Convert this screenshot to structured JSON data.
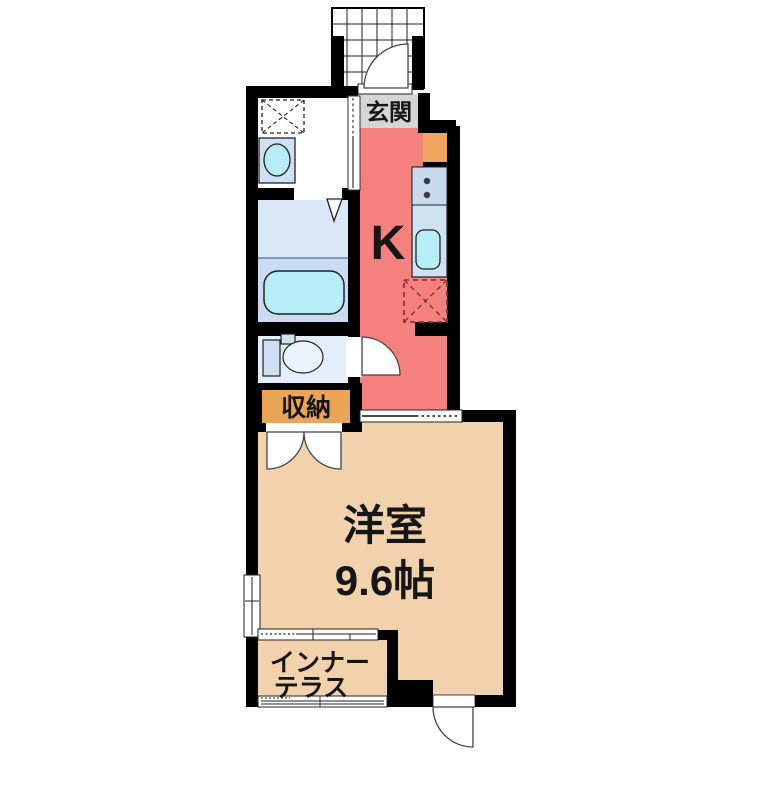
{
  "plan": {
    "title": "1K apartment floor plan",
    "labels": {
      "entrance": "玄関",
      "kitchen": "K",
      "storage": "収納",
      "room_name": "洋室",
      "room_size": "9.6帖",
      "terrace_line1": "インナー",
      "terrace_line2": "テラス"
    },
    "colors": {
      "wall": "#000000",
      "kitchen_floor": "#f5817f",
      "room_floor": "#f2d1ad",
      "entrance_floor": "#d6d6d6",
      "storage_bg": "#e9a455",
      "shoe_cabinet": "#f0a55c",
      "bathroom_upper": "#d9e7f6",
      "bathroom_lower": "#c9dcf1",
      "bathtub": "#b6edf6",
      "toilet_room": "#e4eefb",
      "counter": "#d0e1f3",
      "counter_stove": "#c9d9ed",
      "sink": "#b6edf6",
      "vanity": "#cfe2f4",
      "fixture_fill": "#cfe0f2",
      "fridge_dash": "#8a3535",
      "washroom_floor": "#ffffff"
    }
  }
}
